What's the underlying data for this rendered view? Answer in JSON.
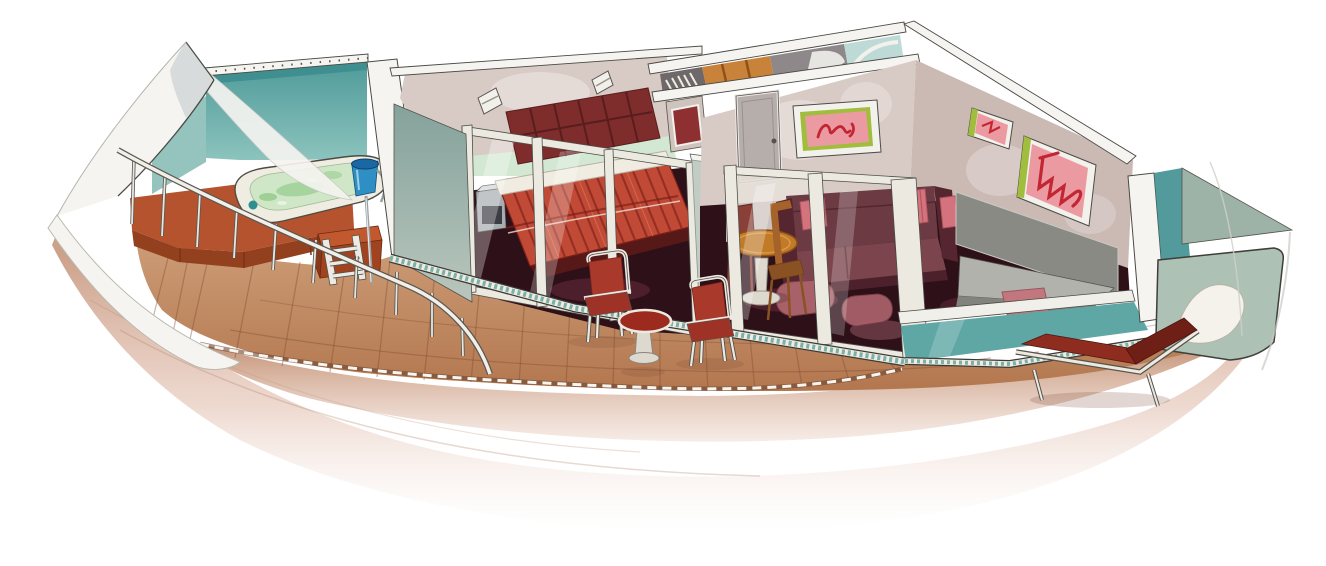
{
  "meta": {
    "title": "Balcony suite cutaway illustration"
  },
  "colors": {
    "background": "#ffffff",
    "hull_white": "#f5f4f0",
    "hull_shade": "#cfd5d7",
    "glass_teal": "#5ea7a4",
    "glass_teal_dark": "#3f8f90",
    "glass_teal_pale": "#8fc0ba",
    "glass_sage": "#9db3a8",
    "glass_panel": "#adc1b5",
    "partition_sage": "#8fa8a0",
    "partition_light": "#c2cbc4",
    "deck_wood": "#c08862",
    "wall_beige": "#d8cac4",
    "wall_beige_dark": "#cbbab4",
    "wall_mint": "#d3e8d3",
    "wall_yellow": "#e7edca",
    "floor_dark": "#2e1019",
    "reflection": "#6b2e40",
    "headboard": "#7e2c2c",
    "bed_red": "#c14a36",
    "bed_stripe": "#8e2a20",
    "pillow_white": "#f0ece1",
    "sofa": "#6b3a43",
    "sofa_dark": "#55262f",
    "sofa_seat": "#7c454e",
    "pillow_pink": "#d4737d",
    "armchair_mauve": "#a86069",
    "table_orange": "#c07a28",
    "wood_chair": "#a5622a",
    "desk_gray": "#b2b2ac",
    "desk_gray_dark": "#83837d",
    "mirror_gray": "#8a8a85",
    "door_gray": "#b6aeaa",
    "art_pink": "#eb9aa2",
    "art_red": "#c32633",
    "art_green": "#a0bd3d",
    "tub_rim": "#efede1",
    "tub_water": "#cfe7c6",
    "tub_jet_green": "#9ed096",
    "bucket_blue": "#2d8fc4",
    "bucket_blue_dark": "#1968a4",
    "terracotta": "#b5532f",
    "terracotta_dark": "#93401f",
    "chair_red": "#a8392b",
    "lounger_red": "#8e2c20",
    "lounger_dark": "#6e1f16",
    "frame_white": "#ece9e1",
    "chrome": "#9aa0a2",
    "closet_wood": "#c9823a",
    "hanger_dark": "#6f686b",
    "bath_gray": "#8e888b",
    "shower_glass": "#bedad6",
    "niche_red": "#8e3032"
  },
  "scene": {
    "rooms": [
      {
        "name": "whirlpool-terrace",
        "items": [
          "whirlpool-tub",
          "ice-bucket",
          "grab-rail",
          "step-ladder",
          "storage-cabinet",
          "curved-railing",
          "teal-glass-wall"
        ]
      },
      {
        "name": "bedroom",
        "items": [
          "double-bed",
          "striped-bedspread",
          "tufted-headboard",
          "nightstand",
          "wall-sconce-left",
          "wall-sconce-right",
          "sliding-glass-doors",
          "mirror-niche"
        ]
      },
      {
        "name": "entry-corridor",
        "items": [
          "hanger-rack",
          "closet-shelves",
          "bathroom",
          "shower-cabin",
          "interior-door"
        ]
      },
      {
        "name": "living-room",
        "items": [
          "sofa",
          "throw-pillows",
          "dining-table",
          "dining-chairs",
          "armchairs",
          "vanity-desk",
          "wall-mirror",
          "stool",
          "artwork-script",
          "artwork-small",
          "artwork-large"
        ]
      },
      {
        "name": "balcony",
        "items": [
          "teak-deck",
          "deck-chair-left",
          "deck-chair-right",
          "pedestal-table",
          "sun-lounger",
          "glass-balustrade",
          "aft-glass-screen"
        ]
      }
    ]
  }
}
